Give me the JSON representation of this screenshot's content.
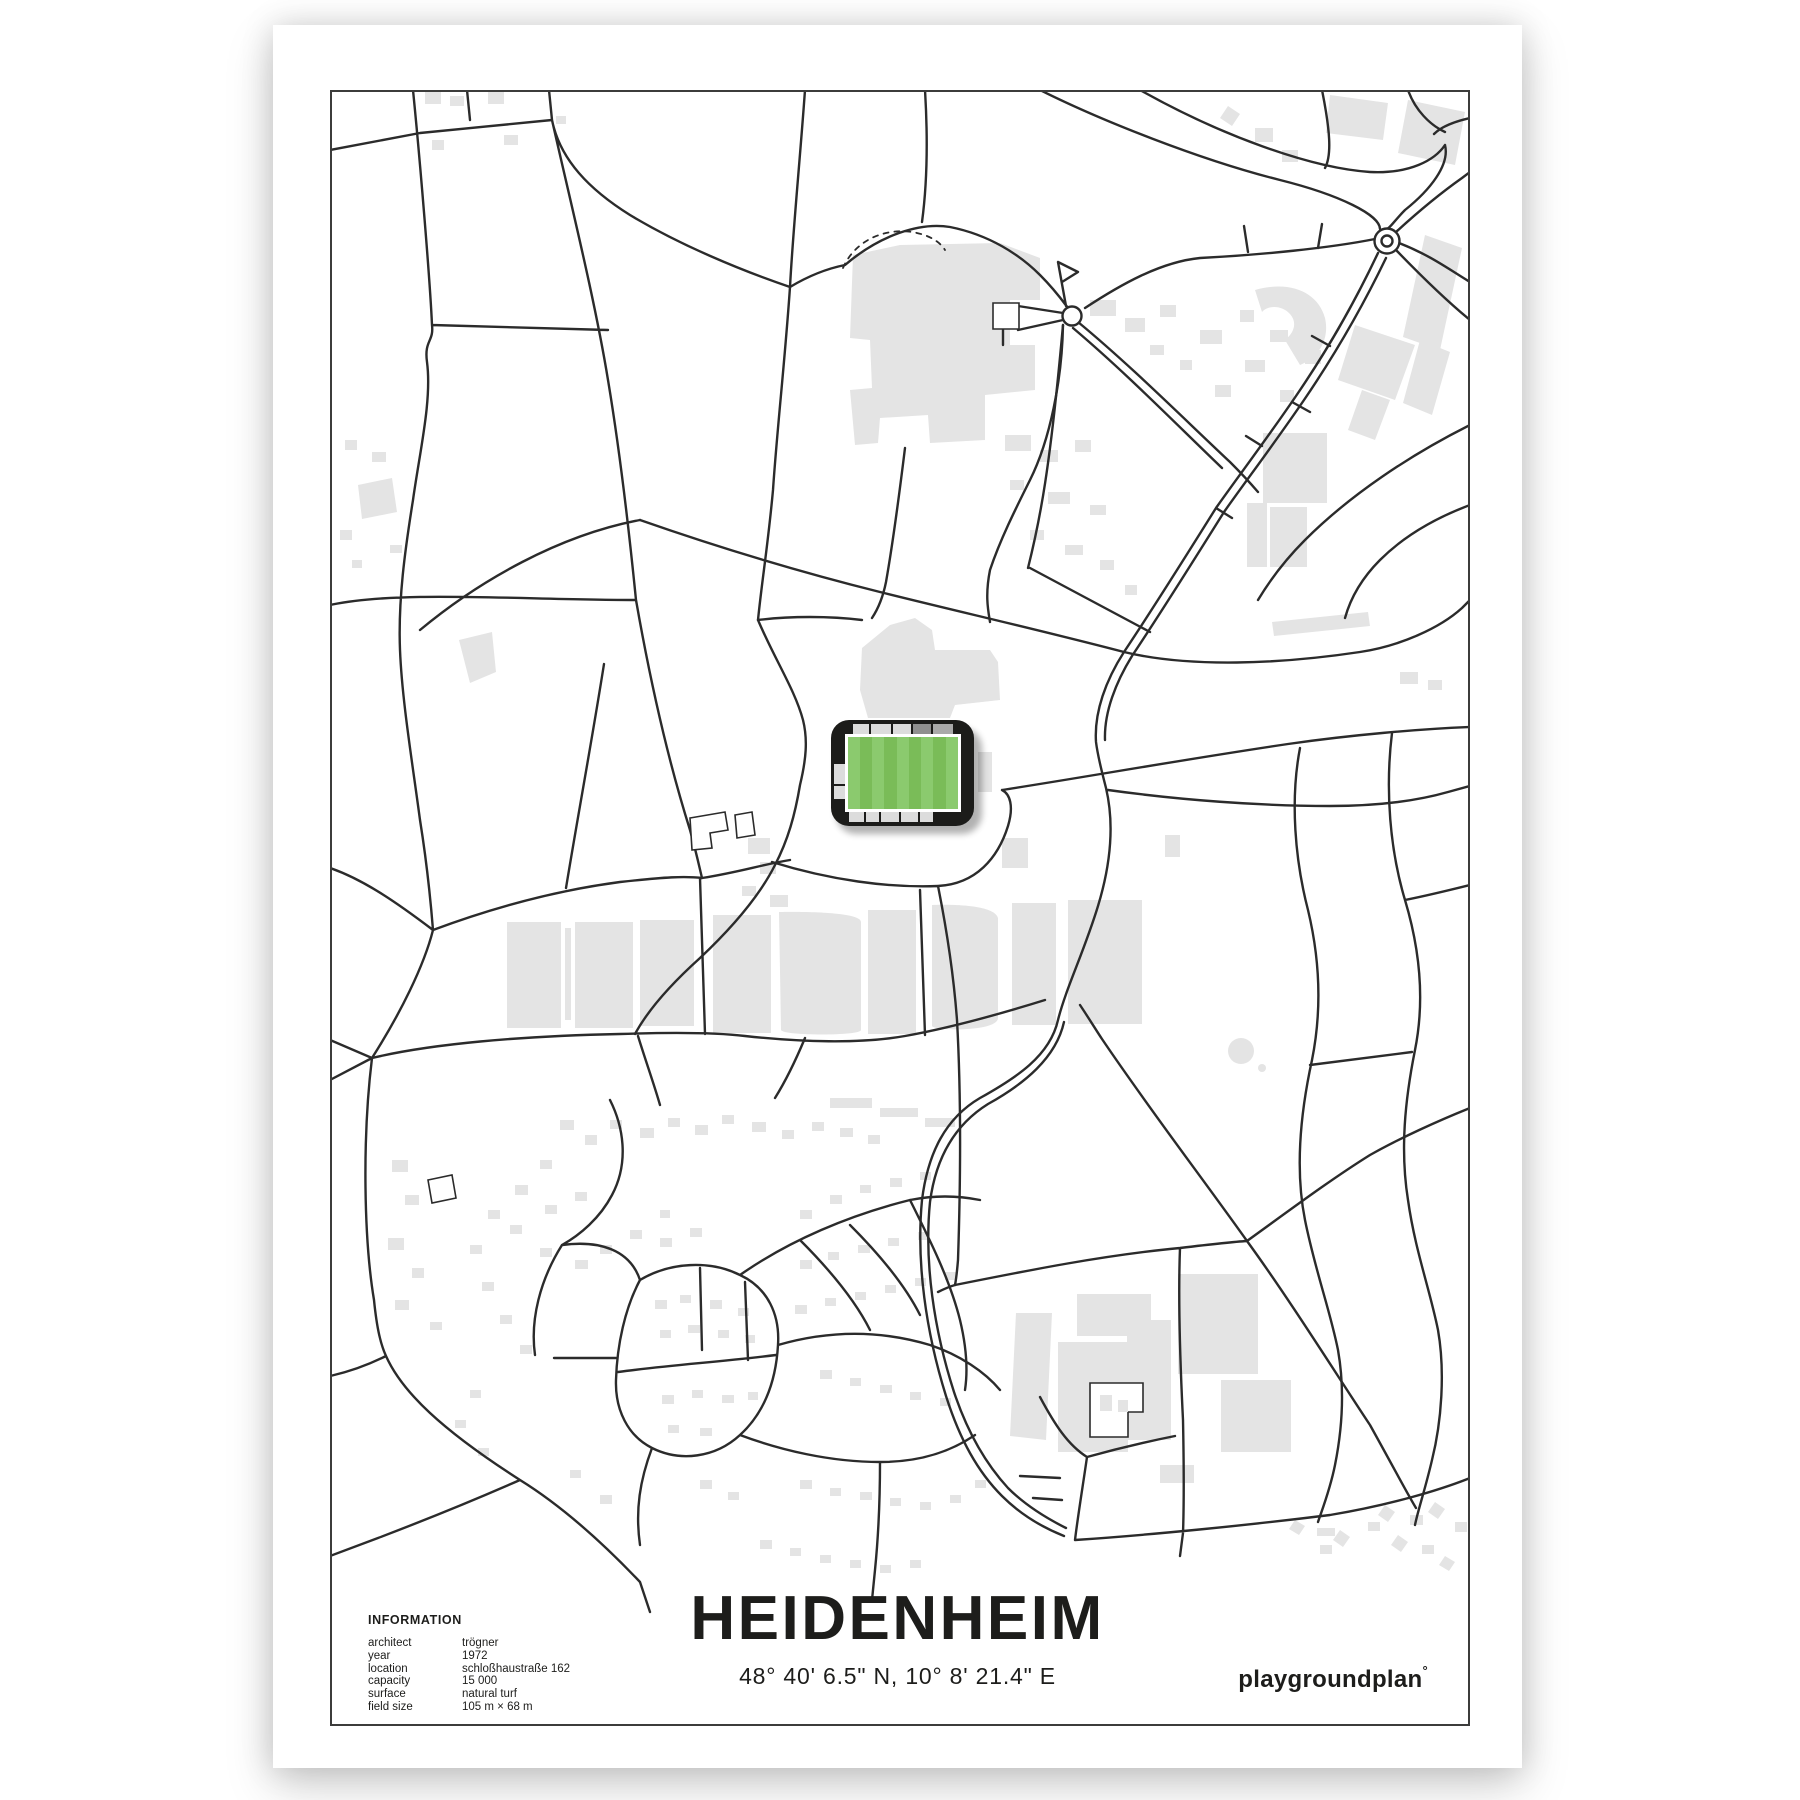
{
  "poster": {
    "title": "HEIDENHEIM",
    "coordinates": "48° 40' 6.5\" N, 10° 8' 21.4\" E",
    "brand": {
      "name": "playgroundplan",
      "mark": "°"
    },
    "information": {
      "heading": "INFORMATION",
      "rows": [
        {
          "label": "architect",
          "value": "trögner"
        },
        {
          "label": "year",
          "value": "1972"
        },
        {
          "label": "location",
          "value": "schloßhaustraße 162"
        },
        {
          "label": "capacity",
          "value": "15 000"
        },
        {
          "label": "surface",
          "value": "natural turf"
        },
        {
          "label": "field size",
          "value": "105 m × 68 m"
        }
      ]
    }
  },
  "map": {
    "kind": "minimal street map with football stadium marker",
    "colors": {
      "road": "#2b2b2b",
      "building": "#e4e4e4",
      "frame": "#3c3c3b",
      "stadium_shell": "#1c1c1a",
      "stand_light": "#dcdcdc",
      "stand_mid": "#a9a9a9",
      "stand_dark": "#8f8f8f",
      "pitch_green": "#7abc58",
      "pitch_stripe": "#8bca6e"
    },
    "features": {
      "stadium": "stadium with green striped pitch",
      "roundabout": "roundabout junction",
      "mini_roundabout": "small roundabout",
      "pond": "pond"
    }
  }
}
